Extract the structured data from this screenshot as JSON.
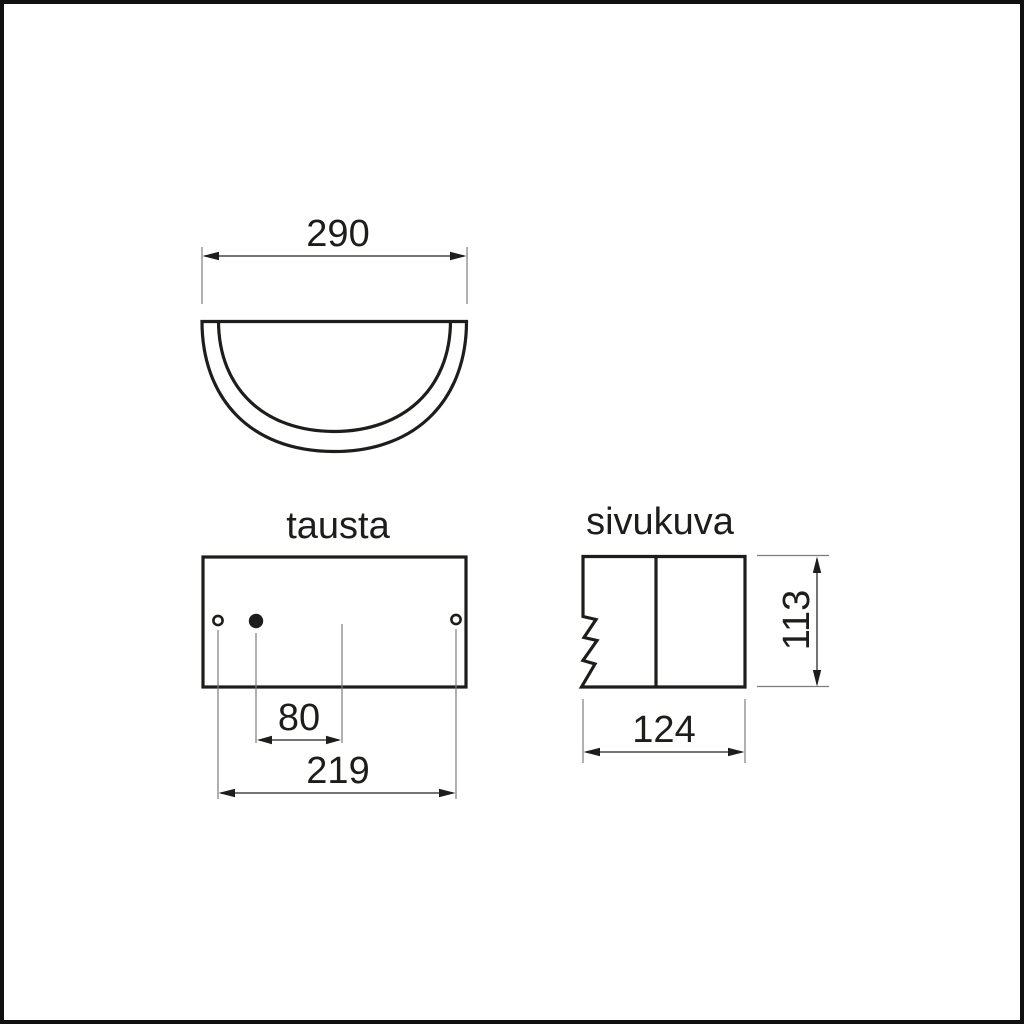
{
  "colors": {
    "background": "#ffffff",
    "outline": "#1d1d1b",
    "dimension_line": "#474747",
    "extension_line": "#7d7d7d",
    "text": "#1d1d1b",
    "page_border": "#101010"
  },
  "views": {
    "top_view": {
      "dim_width": "290"
    },
    "back_view": {
      "label": "tausta",
      "dim_hole_to_center": "80",
      "dim_hole_spacing": "219"
    },
    "side_view": {
      "label": "sivukuva",
      "dim_height": "113",
      "dim_depth": "124"
    }
  }
}
